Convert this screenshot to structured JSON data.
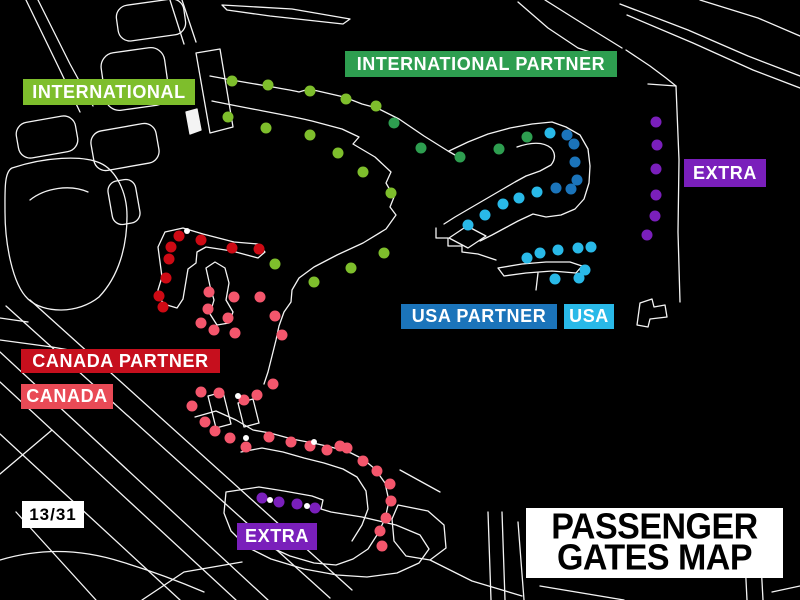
{
  "canvas": {
    "background": "#000000",
    "outline_color": "#F4F4F4"
  },
  "title_box": {
    "line1": "PASSENGER",
    "line2": "GATES MAP",
    "bg": "#FFFFFF",
    "text_color": "#000000",
    "x": 526,
    "y": 508,
    "width": 257,
    "height": 70
  },
  "runway_designator": {
    "text": "13/31",
    "bg": "#FFFFFF",
    "text_color": "#000000",
    "x": 22,
    "y": 501,
    "width": 62,
    "height": 27
  },
  "legend": [
    {
      "id": "international",
      "label": "INTERNATIONAL",
      "bg": "#7EBE2C",
      "text_color": "#FFFFFF",
      "x": 23,
      "y": 79,
      "width": 172,
      "height": 26
    },
    {
      "id": "international_partner",
      "label": "INTERNATIONAL PARTNER",
      "bg": "#2E9E50",
      "text_color": "#FFFFFF",
      "x": 345,
      "y": 51,
      "width": 272,
      "height": 26
    },
    {
      "id": "extra_right",
      "label": "EXTRA",
      "bg": "#7A1FBB",
      "text_color": "#FFFFFF",
      "x": 684,
      "y": 159,
      "width": 82,
      "height": 28
    },
    {
      "id": "usa_partner",
      "label": "USA PARTNER",
      "bg": "#1B74BA",
      "text_color": "#FFFFFF",
      "x": 401,
      "y": 304,
      "width": 156,
      "height": 25
    },
    {
      "id": "usa",
      "label": "USA",
      "bg": "#29B9E8",
      "text_color": "#FFFFFF",
      "x": 564,
      "y": 304,
      "width": 50,
      "height": 25
    },
    {
      "id": "canada_partner",
      "label": "CANADA PARTNER",
      "bg": "#C60F1D",
      "text_color": "#FFFFFF",
      "x": 21,
      "y": 349,
      "width": 199,
      "height": 24
    },
    {
      "id": "canada",
      "label": "CANADA",
      "bg": "#E94A56",
      "text_color": "#FFFFFF",
      "x": 21,
      "y": 384,
      "width": 92,
      "height": 25
    },
    {
      "id": "extra_bottom",
      "label": "EXTRA",
      "bg": "#7A1FBB",
      "text_color": "#FFFFFF",
      "x": 237,
      "y": 523,
      "width": 80,
      "height": 27
    }
  ],
  "gates": {
    "dot_radius": 5.5,
    "white_dot_radius": 3,
    "groups": [
      {
        "name": "international",
        "color": "#7EBE2C",
        "dots": [
          [
            232,
            81
          ],
          [
            268,
            85
          ],
          [
            310,
            91
          ],
          [
            346,
            99
          ],
          [
            376,
            106
          ],
          [
            228,
            117
          ],
          [
            266,
            128
          ],
          [
            310,
            135
          ],
          [
            338,
            153
          ],
          [
            363,
            172
          ],
          [
            391,
            193
          ],
          [
            275,
            264
          ],
          [
            314,
            282
          ],
          [
            351,
            268
          ],
          [
            384,
            253
          ]
        ]
      },
      {
        "name": "international-partner",
        "color": "#2E9E50",
        "dots": [
          [
            394,
            123
          ],
          [
            421,
            148
          ],
          [
            460,
            157
          ],
          [
            499,
            149
          ],
          [
            527,
            137
          ]
        ]
      },
      {
        "name": "usa",
        "color": "#29B9E8",
        "dots": [
          [
            550,
            133
          ],
          [
            537,
            192
          ],
          [
            519,
            198
          ],
          [
            503,
            204
          ],
          [
            485,
            215
          ],
          [
            468,
            225
          ],
          [
            527,
            258
          ],
          [
            540,
            253
          ],
          [
            558,
            250
          ],
          [
            578,
            248
          ],
          [
            591,
            247
          ],
          [
            585,
            270
          ],
          [
            579,
            278
          ],
          [
            555,
            279
          ]
        ]
      },
      {
        "name": "usa-partner",
        "color": "#1B74BA",
        "dots": [
          [
            567,
            135
          ],
          [
            574,
            144
          ],
          [
            575,
            162
          ],
          [
            577,
            180
          ],
          [
            571,
            189
          ],
          [
            556,
            188
          ]
        ]
      },
      {
        "name": "extra",
        "color": "#7A1FBB",
        "dots": [
          [
            656,
            122
          ],
          [
            657,
            145
          ],
          [
            656,
            169
          ],
          [
            656,
            195
          ],
          [
            655,
            216
          ],
          [
            647,
            235
          ],
          [
            262,
            498
          ],
          [
            279,
            502
          ],
          [
            297,
            504
          ],
          [
            315,
            508
          ]
        ]
      },
      {
        "name": "canada-partner",
        "color": "#CE0A14",
        "dots": [
          [
            179,
            236
          ],
          [
            171,
            247
          ],
          [
            201,
            240
          ],
          [
            232,
            248
          ],
          [
            259,
            249
          ],
          [
            169,
            259
          ],
          [
            166,
            278
          ],
          [
            159,
            296
          ],
          [
            163,
            307
          ]
        ]
      },
      {
        "name": "canada",
        "color": "#F4566C",
        "dots": [
          [
            209,
            292
          ],
          [
            234,
            297
          ],
          [
            260,
            297
          ],
          [
            208,
            309
          ],
          [
            228,
            318
          ],
          [
            201,
            323
          ],
          [
            214,
            330
          ],
          [
            235,
            333
          ],
          [
            275,
            316
          ],
          [
            282,
            335
          ],
          [
            273,
            384
          ],
          [
            201,
            392
          ],
          [
            219,
            393
          ],
          [
            244,
            400
          ],
          [
            257,
            395
          ],
          [
            192,
            406
          ],
          [
            205,
            422
          ],
          [
            215,
            431
          ],
          [
            230,
            438
          ],
          [
            246,
            447
          ],
          [
            269,
            437
          ],
          [
            291,
            442
          ],
          [
            310,
            446
          ],
          [
            327,
            450
          ],
          [
            340,
            446
          ],
          [
            347,
            448
          ],
          [
            363,
            461
          ],
          [
            377,
            471
          ],
          [
            390,
            484
          ],
          [
            391,
            501
          ],
          [
            386,
            518
          ],
          [
            380,
            531
          ],
          [
            382,
            546
          ]
        ]
      },
      {
        "name": "unassigned-white",
        "color": "#FFFFFF",
        "small": true,
        "dots": [
          [
            187,
            231
          ],
          [
            238,
            396
          ],
          [
            246,
            438
          ],
          [
            314,
            442
          ],
          [
            270,
            500
          ],
          [
            307,
            506
          ]
        ]
      }
    ]
  }
}
